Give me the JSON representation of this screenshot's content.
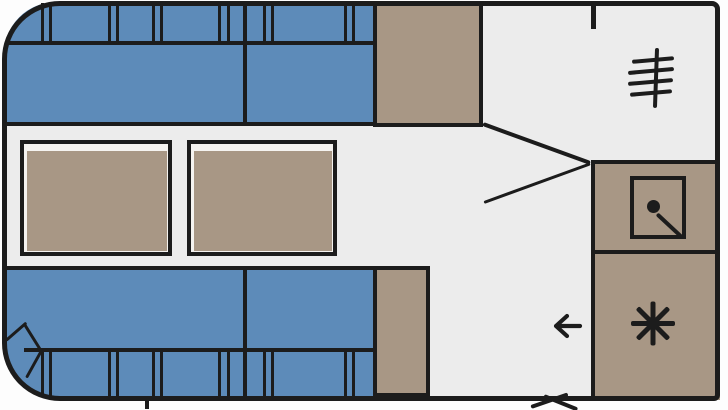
{
  "document": {
    "description": "hand-drawn caravan floor plan sketch, no text labels"
  },
  "colors": {
    "background": "#fdfdfd",
    "floor": "#ececec",
    "outline": "#1c1c1c",
    "seat_blue": "#5d8bb9",
    "cabinet_tan": "#a89785",
    "table_white": "#f5f3f0"
  },
  "furniture": {
    "front_bench_sections": 2,
    "rear_bench_sections": 2,
    "tables": 2,
    "side_cabinets": 2,
    "kitchen_counter_sections": 2,
    "backrest_cushion_divider_pairs_per_side": 6
  },
  "icons": {
    "grille_icon": "four horizontal strokes crossed by a vertical stroke",
    "sink_icon": "square with round drain dot and diagonal stroke",
    "snowflake_icon": "eight-point asterisk",
    "entry_arrow_icon": "←",
    "door_swing_marks": "two short diagonal strokes crossing the bottom wall"
  }
}
